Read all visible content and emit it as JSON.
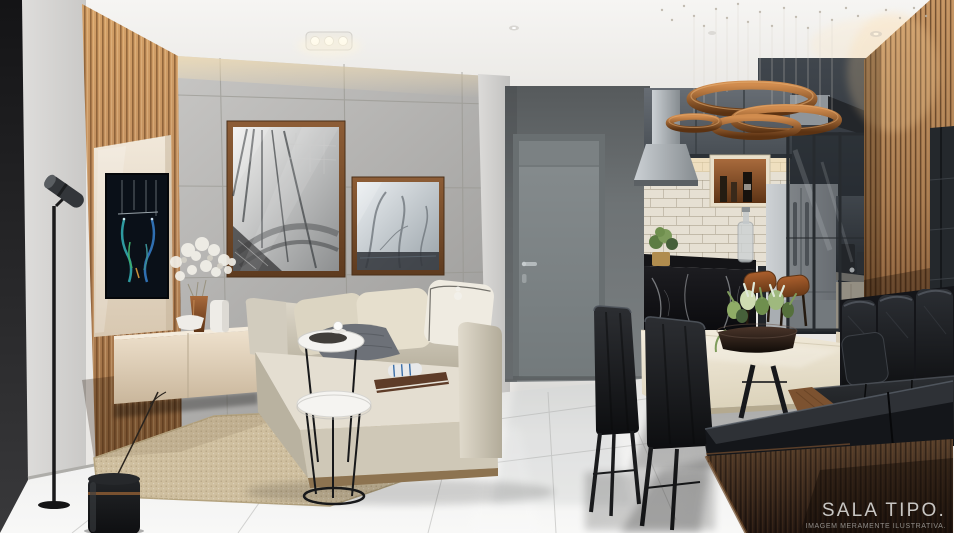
{
  "caption": {
    "title": "SALA TIPO.",
    "subtitle": "IMAGEM MERAMENTE ILUSTRATIVA."
  },
  "palette": {
    "caption_title": "#c8c6c3",
    "caption_subtitle": "#908d89",
    "ceiling": "#f2f0ed",
    "left_wall": "#d8d7d5",
    "concrete_wall": "#b3b2b0",
    "wood_slat_light": "#c2905f",
    "wood_slat_dark": "#8a5c34",
    "tv_panel_cream": "#e9ddcb",
    "door_gray": "#7f8587",
    "niche_gray": "#6f7476",
    "floor_tile": "#eeeeec",
    "rug_jute": "#cdbd9e",
    "sofa_beige": "#d9d3c5",
    "leather_black": "#17181b",
    "copper_pendant": "#a96a38",
    "marble_black": "#131316",
    "dining_table_cream": "#e9e1cf",
    "stainless_steel": "#b0b5b9"
  }
}
